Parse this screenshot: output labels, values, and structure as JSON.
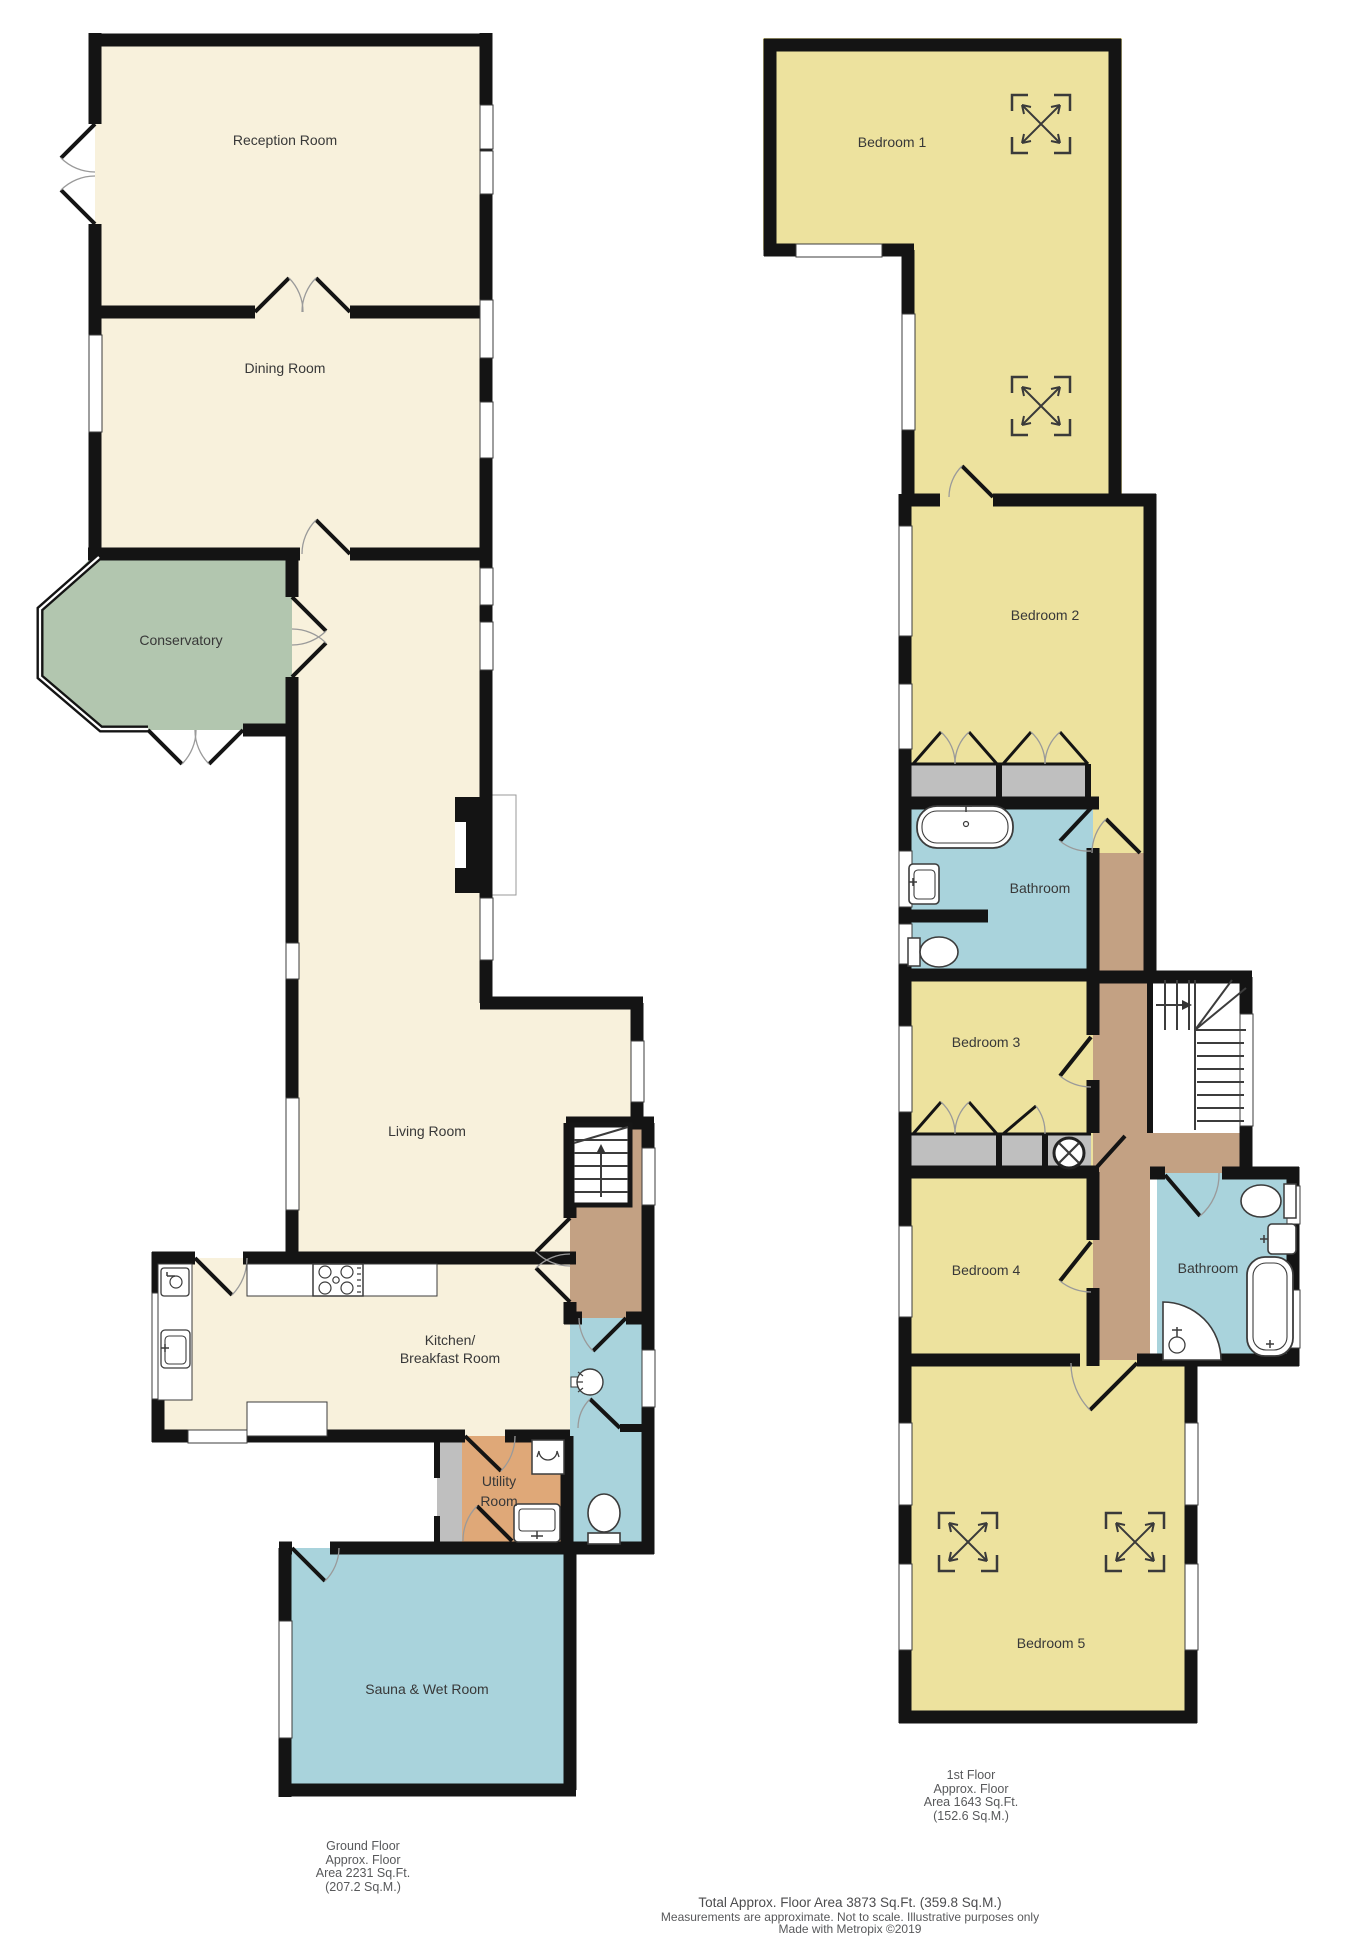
{
  "document": {
    "type": "floorplan",
    "floors": 2
  },
  "rooms": {
    "ground": {
      "reception": "Reception Room",
      "dining": "Dining Room",
      "conservatory": "Conservatory",
      "living": "Living Room",
      "kitchen_line1": "Kitchen/",
      "kitchen_line2": "Breakfast Room",
      "utility_line1": "Utility",
      "utility_line2": "Room",
      "sauna": "Sauna & Wet Room"
    },
    "first": {
      "bedroom1": "Bedroom 1",
      "bedroom2": "Bedroom 2",
      "bathroom1": "Bathroom",
      "bedroom3": "Bedroom 3",
      "bedroom4": "Bedroom 4",
      "bathroom2": "Bathroom",
      "bedroom5": "Bedroom 5"
    }
  },
  "footer": {
    "ground_floor": {
      "line1": "Ground Floor",
      "line2": "Approx. Floor",
      "line3": "Area 2231 Sq.Ft.",
      "line4": "(207.2 Sq.M.)"
    },
    "first_floor": {
      "line1": "1st Floor",
      "line2": "Approx. Floor",
      "line3": "Area 1643 Sq.Ft.",
      "line4": "(152.6 Sq.M.)"
    },
    "total": "Total Approx. Floor Area 3873 Sq.Ft. (359.8 Sq.M.)",
    "disclaimer": "Measurements are approximate.  Not to scale.  Illustrative purposes only",
    "credit": "Made with Metropix ©2019"
  },
  "icons": [
    "stove-icon",
    "kitchen-sink-icon",
    "washing-machine-icon",
    "utility-sink-icon",
    "shower-head-icon",
    "toilet-icon",
    "bathtub-icon",
    "basin-icon",
    "shower-tray-icon",
    "staircase-up-icon",
    "skylight-icon",
    "water-tank-icon"
  ],
  "colors": {
    "room_cream": "#F8F1DC",
    "room_yellow": "#EDE29E",
    "room_green": "#B2C6AF",
    "room_blue": "#A9D3DC",
    "hall_brown": "#C3A183",
    "utility_orange": "#DFA878",
    "closet_gray": "#BFBFBF",
    "wall": "#141414"
  }
}
